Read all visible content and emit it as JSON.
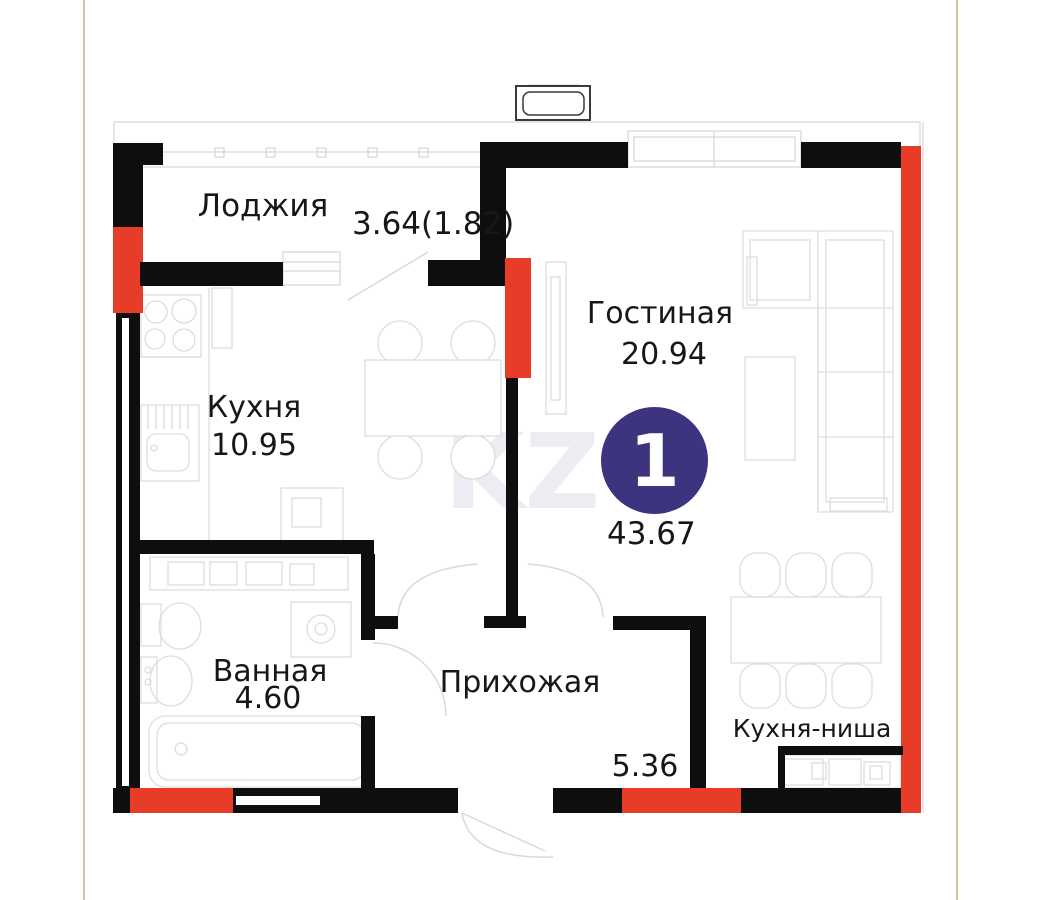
{
  "badge": {
    "room_count": "1",
    "total_area": "43.67"
  },
  "rooms": {
    "loggia": {
      "label": "Лоджия",
      "area": "3.64(1.82)"
    },
    "kitchen": {
      "label": "Кухня",
      "area": "10.95"
    },
    "living_room": {
      "label": "Гостиная",
      "area": "20.94"
    },
    "bathroom": {
      "label": "Ванная",
      "area": "4.60"
    },
    "hallway": {
      "label": "Прихожая",
      "area": "5.36"
    },
    "kitchen_niche": {
      "label": "Кухня-ниша"
    }
  },
  "watermark": "KZ",
  "colors": {
    "wall_black": "#0e0e0e",
    "wall_red": "#e63c28",
    "badge_indigo": "#3d3480",
    "furniture_line": "#dcdde3",
    "page_guide": "#d9c398"
  }
}
